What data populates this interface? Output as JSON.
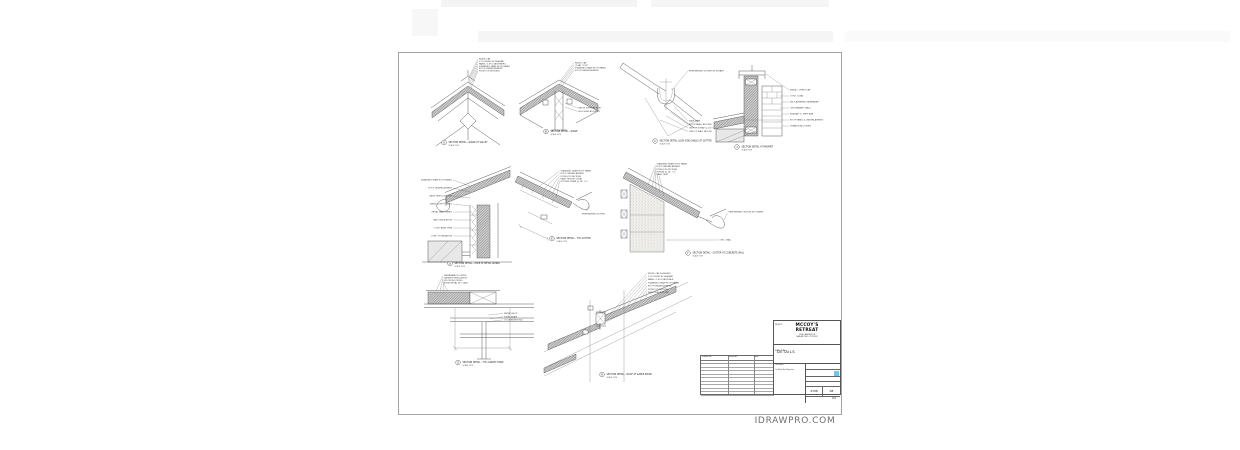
{
  "sheet": {
    "watermark": "IDRAWPRO.COM"
  },
  "title_block": {
    "project_label": "PROJECT:",
    "project_name_line1": "MCCOY'S",
    "project_name_line2": "RETREAT",
    "project_address_line1": "1208 LAKESIDE DR",
    "project_address_line2": "SAN ANTONIO, TX 78232",
    "sheet_title_label": "SHEET TITLE:",
    "sheet_title": "DETAILS",
    "customer_label": "Customer:",
    "customer_name": "On Point Roof Systems",
    "date_label": "DATE:",
    "date_value": "03/08/2024",
    "drawn_label": "DRAWN:",
    "drawn_value": "IDRAWPRO.COM",
    "drawn_by_label": "DRAWN BY:",
    "drawn_by_value": "CAD",
    "scale_label": "SCALE:",
    "scale_value": "AS TO SCALE",
    "project_no_label": "PROJECT NO:",
    "project_no_value": "2708",
    "drawing_no_label": "DRAWING NO:",
    "drawing_no_value": "08",
    "sheet_no_label": "SHEET NO:",
    "sheet_no_value": "D1",
    "accent_color": "#6ec6ea"
  },
  "revision_table": {
    "headers": [
      "SUBMITTAL",
      "REVISIONS",
      "DATE"
    ],
    "subrow": [
      "ISSUE",
      "",
      "03/2024"
    ]
  },
  "details": [
    {
      "label": "A",
      "caption": "SECTION DETAIL - RIDGE AT VALLEY",
      "scale": "SCALE: NTS",
      "annotations": [
        "RIDGE CAP",
        "Z-CLOSURE W/ SEALANT",
        "PANEL CLIP & FASTENERS",
        "STANDING SEAM ROOF PANEL",
        "ROOF UNDERLAYMENT",
        "PLYWOOD DECKING"
      ]
    },
    {
      "label": "B",
      "caption": "SECTION DETAIL - RIDGE",
      "scale": "SCALE: NTS",
      "annotations": [
        "RIDGE CAP",
        "CLEAT CONT.",
        "STANDING SEAM ROOF PANEL",
        "ROOF UNDERLAYMENT",
        "RIDGE SUPPORT POST",
        "BLOCKING AS REQ'D"
      ]
    },
    {
      "label": "C",
      "caption": "SECTION DETAIL (LOW SIDE GABLE) AT GUTTER",
      "scale": "SCALE: NTS",
      "annotations": [
        "PREFINISHED GUTTER W/ STRAPS",
        "EAVE TRIM",
        "ROOF PANEL BEYOND",
        "GUTTER STRAP @ 24\" O.C.",
        "LINE OF WALL BELOW"
      ]
    },
    {
      "label": "1",
      "caption": "SECTION DETAIL AT PARAPET",
      "scale": "SCALE: NTS",
      "annotations": [
        "METAL COPING CAP",
        "CONT. CLEAT",
        "SELF-ADHERED MEMBRANE",
        "CMU PARAPET WALL",
        "SEALANT & TERM BAR",
        "ROOF PANEL & UNDERLAYMENT",
        "TREATED BLOCKING"
      ]
    },
    {
      "label": "D",
      "caption": "SECTION DETAIL - EAVE AT METAL SIDING",
      "scale": "SCALE: NTS",
      "annotations": [
        "STANDING SEAM ROOF PANEL",
        "ROOF UNDERLAYMENT",
        "EAVE TRIM & GUTTER",
        "METAL SOFFIT PANEL",
        "METAL WALL PANEL",
        "BATT INSULATION",
        "CONT. BASE TRIM",
        "CONC. FOUNDATION"
      ]
    },
    {
      "label": "E",
      "caption": "SECTION DETAIL - TYP. GUTTER",
      "scale": "SCALE: NTS",
      "annotations": [
        "STANDING SEAM ROOF PANEL",
        "ROOF UNDERLAYMENT",
        "PLYWOOD DECKING",
        "EAVE TRIM W/ CLEAT",
        "GUTTER STRAP @ 24\" O.C.",
        "PREFINISHED GUTTER"
      ]
    },
    {
      "label": "F",
      "caption": "SECTION DETAIL - GUTTER AT CONCRETE WALL",
      "scale": "SCALE: NTS",
      "annotations": [
        "STANDING SEAM ROOF PANEL",
        "ROOF UNDERLAYMENT",
        "PLYWOOD DECKING",
        "PURLIN @ 24\" O.C.",
        "EAVE TRIM",
        "PREFINISHED GUTTER W/ STRAPS",
        "CONC. WALL"
      ]
    },
    {
      "label": "G",
      "caption": "SECTION DETAIL - TYP. CANOPY EDGE",
      "scale": "SCALE: NTS",
      "annotations": [
        "MEMBRANE ROOFING",
        "TAPERED INSULATION",
        "WOOD BLOCKING",
        "EDGE METAL W/ CLEAT",
        "METAL DECK",
        "STEEL BEAM",
        "COLUMN BEYOND"
      ]
    },
    {
      "label": "H",
      "caption": "SECTION DETAIL - ROOF AT GABLE RIDGE",
      "scale": "SCALE: NTS",
      "annotations": [
        "RIDGE CAP FLASHING",
        "Z-CLOSURE W/ SEALANT",
        "PANEL CLIP & FASTENER",
        "STANDING SEAM ROOF PANEL",
        "ROOF UNDERLAYMENT",
        "PLYWOOD DECKING",
        "RAKE TRIM BEYOND"
      ]
    }
  ]
}
